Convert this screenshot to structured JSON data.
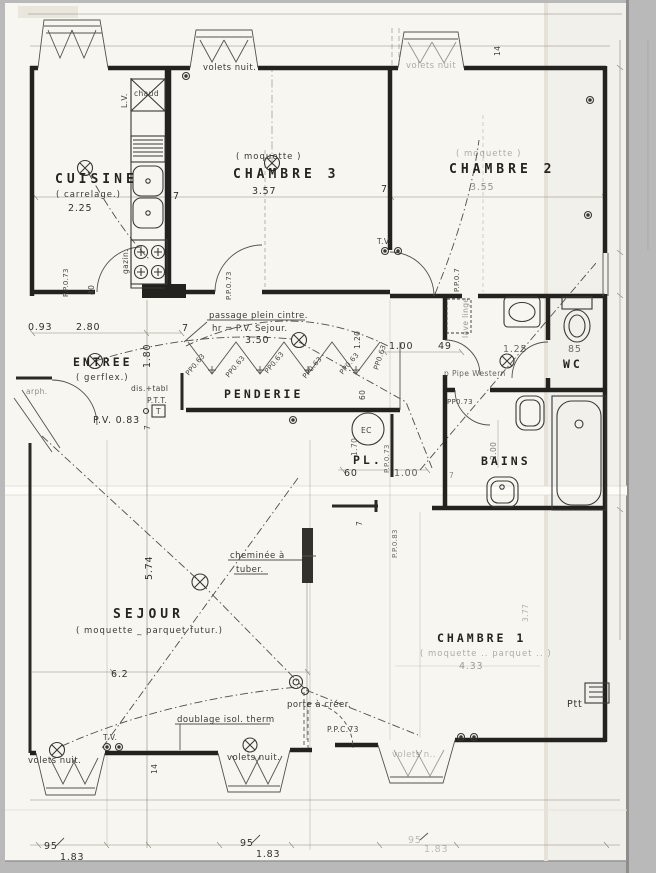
{
  "palette": {
    "paper": "#f8f6f1",
    "scan_edge": "#b9b9b9",
    "ink": "#24221e",
    "crease": "#e6e2da"
  },
  "rooms": {
    "cuisine": {
      "name": "CUISINE",
      "material": "( carrelage.)",
      "width": "2.25"
    },
    "chambre3": {
      "name": "CHAMBRE 3",
      "material": "( moquette )",
      "width": "3.57"
    },
    "chambre2": {
      "name": "CHAMBRE 2",
      "material": "( moquette )",
      "width": "3.55"
    },
    "entree": {
      "name": "ENTREE",
      "material": "( gerflex.)"
    },
    "penderie": {
      "name": "PENDERIE"
    },
    "sejour": {
      "name": "SEJOUR",
      "material": "( moquette _ parquet  futur.)",
      "width": "6.2",
      "depth": "5.74"
    },
    "chambre1": {
      "name": "CHAMBRE 1",
      "material": "( moquette ..  parquet .. )",
      "width": "4.33",
      "depth": "3.77"
    },
    "bains": {
      "name": "BAINS",
      "depth": "2.00"
    },
    "wc": {
      "name": "WC",
      "width": "85"
    },
    "placard": {
      "name": "PL.",
      "width": "60",
      "offset": "1.00",
      "depth": "1.70"
    }
  },
  "fixtures": {
    "lave_vaisselle": "L.V.",
    "chauffe_eau": "chaud",
    "gaziniere": "gazin.",
    "eau_chaude": "EC",
    "tv_top": "T.V.",
    "tv_bottom": "T.V.",
    "ptt_entree": "P.T.T.",
    "ptt_box": "T",
    "dis_tabl": "dis.+tabl",
    "lave_linge": "lave linge",
    "pipe": "p Pipe Western",
    "ptt_chambre1": "Ptt"
  },
  "annotations": {
    "volets_top_mid": "volets nuit.",
    "volets_top_right": "volets nuit",
    "volets_bot_left": "volets nuit.",
    "volets_bot_mid": "volets nuit.",
    "volets_bot_right": "volets n..",
    "passage_line1": "passage plein cintre.",
    "passage_line2": "hr = P.V. Sejour.",
    "passage_height": "3.50",
    "cheminee_line1": "cheminée à",
    "cheminee_line2": "tuber.",
    "doublage": "doublage isol. therm",
    "porte_creer": "porte à créer.",
    "arph": "arph."
  },
  "doors": {
    "pp063": "PP0.63",
    "pp073": "P.P.0.73",
    "pp073_plain": "PP0.73",
    "pp07": "P.P.0.7",
    "pp083": "P.P.0.83",
    "ppc73": "P.P.C.73",
    "pv083": "P.V.  0.83"
  },
  "dimensions": {
    "d093": "0.93",
    "d280": "2.80",
    "d180": "1.80",
    "d40": "40",
    "d7": "7",
    "d120": "1.20",
    "d60": "60",
    "d100": "1.00",
    "d49": "49",
    "d125": "1.25",
    "d85": "85",
    "d14": "14",
    "d95": "95",
    "d183": "1.83"
  }
}
